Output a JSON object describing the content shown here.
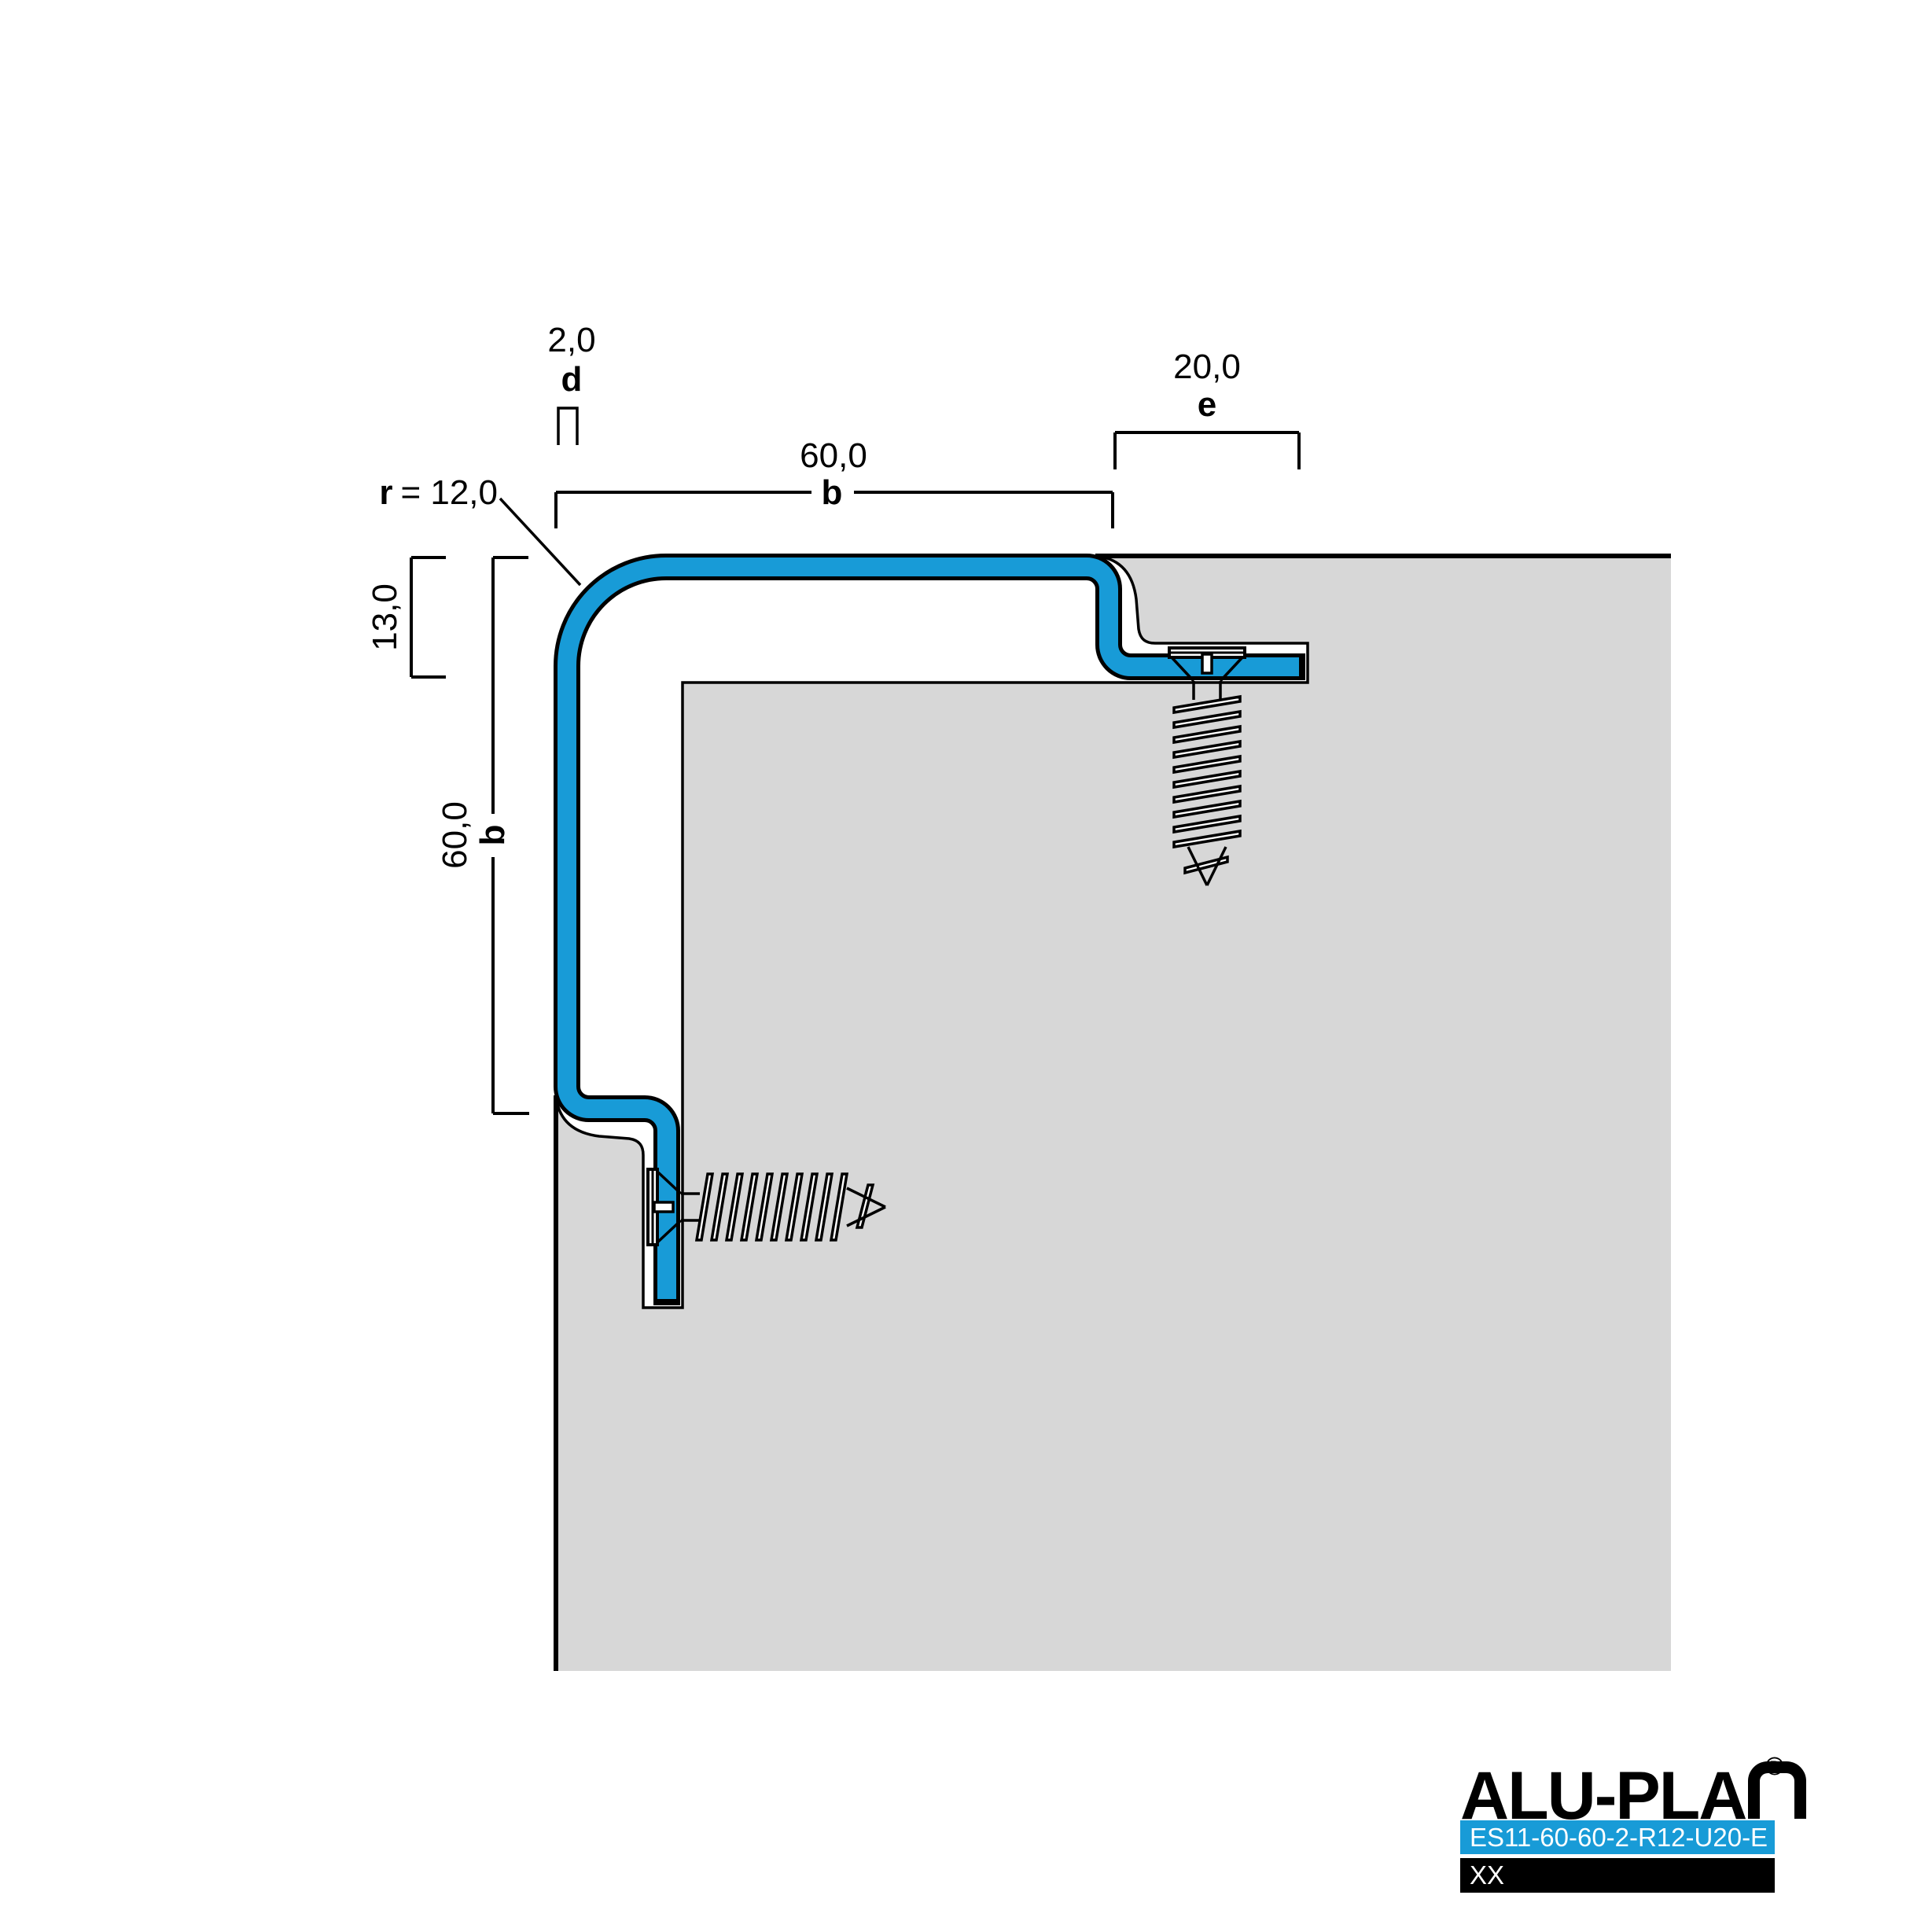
{
  "drawing": {
    "title": "edge profile cross-section",
    "dimensions": {
      "thickness": {
        "value": "2,0",
        "symbol": "d"
      },
      "radius": {
        "symbol": "r",
        "value": "= 12,0"
      },
      "width_top": {
        "value": "60,0",
        "symbol": "b"
      },
      "edge_top": {
        "value": "20,0",
        "symbol": "e"
      },
      "inset_left": {
        "value": "13,0"
      },
      "height_left": {
        "value": "60,0",
        "symbol": "b"
      }
    },
    "colors": {
      "profile": "#189bd7",
      "substrate": "#d7d7d7",
      "outline": "#000000"
    }
  },
  "logo": {
    "brand": "ALU-PLA",
    "brand_last_letter": "N",
    "registered": "®",
    "product_code": "ES11-60-60-2-R12-U20-E",
    "note": "XX",
    "bar_blue": "#189bd7",
    "bar_black": "#000000"
  }
}
